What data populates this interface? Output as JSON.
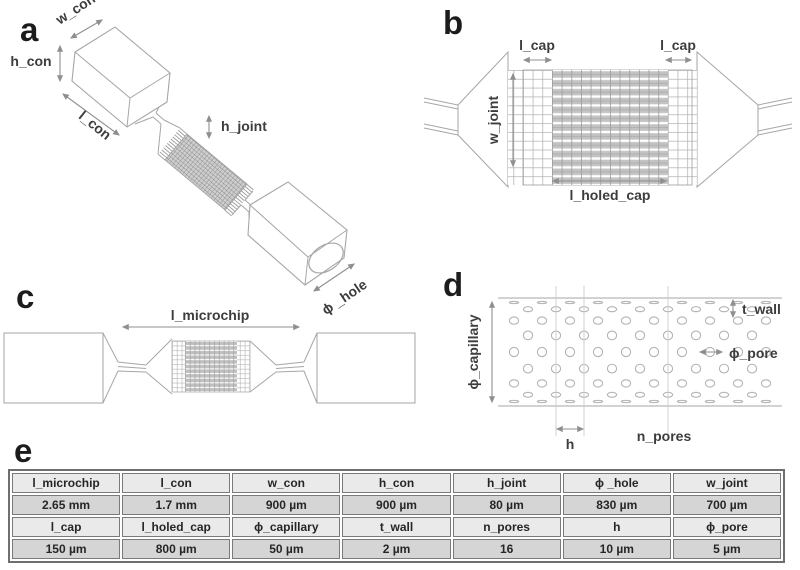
{
  "figure": {
    "panels": {
      "a": {
        "letter": "a",
        "labels": {
          "w_con": "w_con",
          "h_con": "h_con",
          "l_con": "l_con",
          "h_joint": "h_joint",
          "phi_hole": "ϕ _hole"
        }
      },
      "b": {
        "letter": "b",
        "labels": {
          "l_cap_left": "l_cap",
          "l_cap_right": "l_cap",
          "w_joint": "w_joint",
          "l_holed_cap": "l_holed_cap"
        }
      },
      "c": {
        "letter": "c",
        "labels": {
          "l_microchip": "l_microchip"
        }
      },
      "d": {
        "letter": "d",
        "labels": {
          "phi_capillary": "ϕ_capillary",
          "t_wall": "t_wall",
          "phi_pore": "ϕ_pore",
          "h": "h",
          "n_pores": "n_pores"
        }
      },
      "e": {
        "letter": "e"
      }
    },
    "table": {
      "rows": [
        {
          "type": "header",
          "cells": [
            "l_microchip",
            "l_con",
            "w_con",
            "h_con",
            "h_joint",
            "ϕ _hole",
            "w_joint"
          ]
        },
        {
          "type": "value",
          "cells": [
            "2.65 mm",
            "1.7 mm",
            "900 µm",
            "900 µm",
            "80 µm",
            "830 µm",
            "700 µm"
          ]
        },
        {
          "type": "header",
          "cells": [
            "l_cap",
            "l_holed_cap",
            "ϕ_capillary",
            "t_wall",
            "n_pores",
            "h",
            "ϕ_pore"
          ]
        },
        {
          "type": "value",
          "cells": [
            "150 µm",
            "800 µm",
            "50 µm",
            "2 µm",
            "16",
            "10 µm",
            "5 µm"
          ]
        }
      ]
    },
    "colors": {
      "outline": "#a6a6a6",
      "arrow": "#8f8f8f",
      "label": "#3d3d3d",
      "hatch_fill": "#c3c3c3",
      "table_header_bg": "#eaeaea",
      "table_value_bg": "#d5d5d5",
      "table_border": "#7a7a7a"
    }
  }
}
